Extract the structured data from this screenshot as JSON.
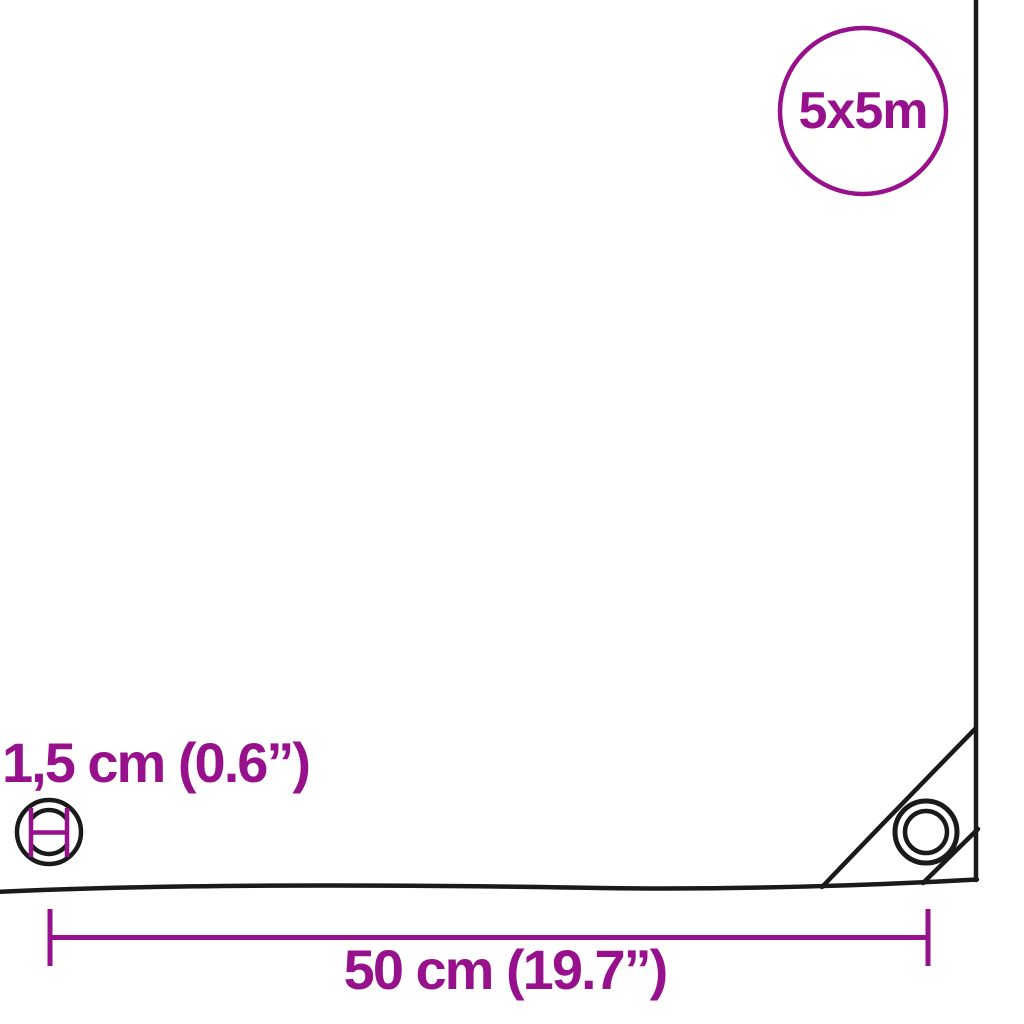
{
  "diagram": {
    "title": "tarpaulin-dimension-diagram",
    "badge": {
      "label": "5x5m"
    },
    "annotations": {
      "grommet_size": "1,5 cm (0.6”)",
      "grommet_spacing": "50 cm (19.7”)"
    },
    "icons": [
      "grommet-icon",
      "corner-grommet-icon",
      "size-badge-circle"
    ],
    "colors": {
      "accent": "#97108c",
      "line": "#1a1a1a",
      "background": "#ffffff"
    }
  }
}
